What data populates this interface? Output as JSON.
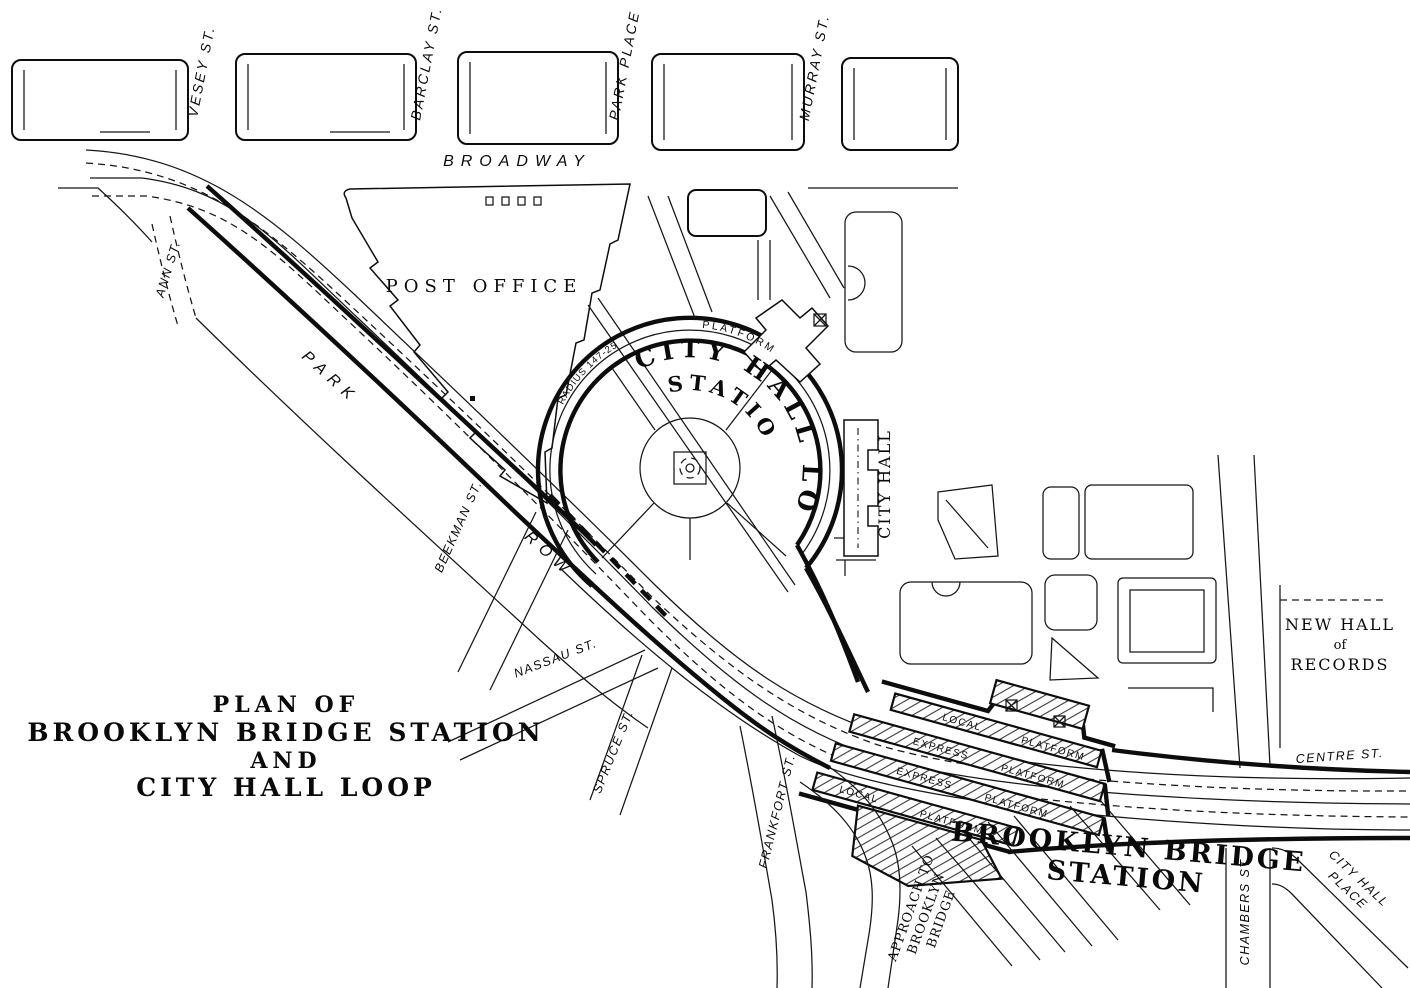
{
  "map_title": {
    "lines": [
      "PLAN OF",
      "BROOKLYN BRIDGE STATION",
      "AND",
      "CITY HALL LOOP"
    ]
  },
  "streets": {
    "vesey": "VESEY ST.",
    "barclay": "BARCLAY ST.",
    "park_place": "PARK PLACE",
    "murray": "MURRAY ST.",
    "broadway": "BROADWAY",
    "ann": "ANN ST.",
    "park": "PARK",
    "row": "ROW",
    "beekman": "BEEKMAN ST.",
    "nassau": "NASSAU ST.",
    "spruce": "SPRUCE ST.",
    "frankfort": "FRANKFORT ST.",
    "chambers": "CHAMBERS ST.",
    "centre": "CENTRE ST.",
    "city_hall_place": [
      "CITY HALL",
      "PLACE"
    ]
  },
  "buildings": {
    "post_office": "POST OFFICE",
    "city_hall": "CITY HALL",
    "new_hall_of_records": [
      "NEW HALL",
      "of",
      "RECORDS"
    ]
  },
  "city_hall_loop": {
    "name": "CITY HALL LOOP",
    "name2": "STATION",
    "platform": "PLATFORM",
    "radius_note": "RADIUS 147-25"
  },
  "brooklyn_bridge_station": {
    "name": [
      "BROOKLYN BRIDGE",
      "STATION"
    ],
    "platforms": [
      {
        "type": "LOCAL",
        "label": "PLATFORM"
      },
      {
        "type": "EXPRESS",
        "label": "PLATFORM"
      },
      {
        "type": "EXPRESS",
        "label": "PLATFORM"
      },
      {
        "type": "LOCAL",
        "label": "PLATFORM"
      }
    ],
    "approach": [
      "APPROACH TO",
      "BROOKLYN",
      "BRIDGE"
    ]
  }
}
